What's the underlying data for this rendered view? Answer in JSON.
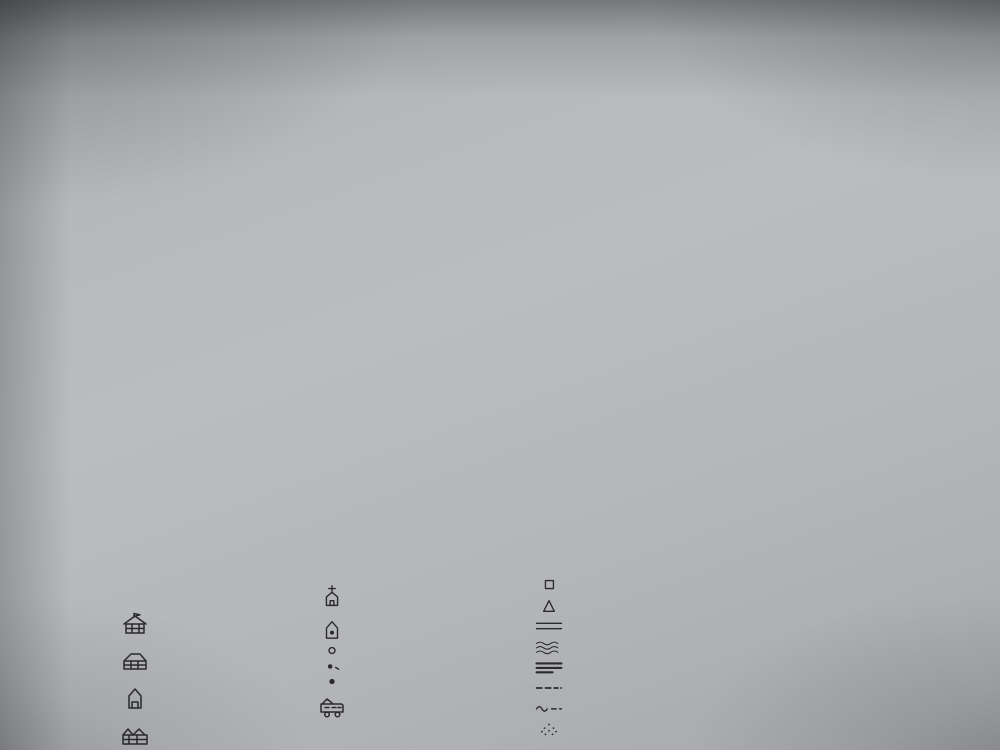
{
  "map": {
    "labels": [
      {
        "id": "ds-langir",
        "text": "DS. LANGIR"
      },
      {
        "id": "rt-07",
        "text": "RT. 07"
      },
      {
        "id": "dsn-hb-longir",
        "text": "Dsn. Hb. Longir"
      },
      {
        "id": "rt-09",
        "text": "RT. 09"
      },
      {
        "id": "jalan-maumere-larantuka",
        "text": "Maumere  -  Larantuka"
      },
      {
        "id": "laut-flores",
        "text": "Laut Flores"
      },
      {
        "id": "rt-10",
        "text": "RT. 10"
      },
      {
        "id": "rt-11",
        "text": "RT 11"
      },
      {
        "id": "rt-12",
        "text": "RT 12"
      },
      {
        "id": "rt-13",
        "text": "RT 13"
      },
      {
        "id": "dsn-wair-habi",
        "text": "Dsn. Wair Habi"
      },
      {
        "id": "rt-06",
        "text": "RT. 06"
      },
      {
        "id": "rt-05",
        "text": "RT 05"
      },
      {
        "id": "rt-03",
        "text": "RT. 03"
      },
      {
        "id": "rt-02",
        "text": "RT. 02"
      },
      {
        "id": "rt-01",
        "text": "RT 01"
      },
      {
        "id": "dsn-habi-gahar",
        "text": "Dsn Habi Gahar"
      },
      {
        "id": "rt-04",
        "text": "RT. 04"
      },
      {
        "id": "ds-watuliwung",
        "text": "DS. WATULIWUNG"
      },
      {
        "id": "compass-north",
        "text": "U"
      }
    ],
    "ink_color": "#2a2a2f",
    "paper_color": "#b7b9bc"
  },
  "legend": {
    "title": "Legenda:",
    "eq": "=",
    "col1": [
      {
        "icon": "school-icon",
        "label": "Sekolah (SD,TK,SMP)"
      },
      {
        "icon": "biara-icon",
        "label": "Biara"
      },
      {
        "icon": "posyandu-icon",
        "label": "Posyandu"
      },
      {
        "icon": "kantor-desa-icon",
        "label": "Kantor Desa"
      }
    ],
    "col2": [
      {
        "icon": "gereja-icon",
        "label": "Gereja / Kapela"
      },
      {
        "icon": "pustu-icon",
        "label": "Pustu / Polindes."
      },
      {
        "icon": "rumah-miskin-icon",
        "label": "Rumah Tg. Miskin"
      },
      {
        "icon": "rumah-kaya-icon",
        "label": "Rmh Tngga Kaya"
      },
      {
        "icon": "rumah-sedang-icon",
        "label": "Rmh Tngga Sedang"
      },
      {
        "icon": "terminal-bis-icon",
        "label": "Terminal Bis."
      }
    ],
    "col3": [
      {
        "icon": "embung-icon",
        "label": "Embung"
      },
      {
        "icon": "titik-air-icon",
        "label": "Titik Air"
      },
      {
        "icon": "jalan-raya-icon",
        "label": "Jalan Raya"
      },
      {
        "icon": "kali-icon",
        "label": "Kali"
      },
      {
        "icon": "jalan-dusun-icon",
        "label": "Jalan Dusun / Desa"
      },
      {
        "icon": "batas-desa-icon",
        "label": "Batas Desa"
      },
      {
        "icon": "batas-rt-icon",
        "label": "Batas RT"
      },
      {
        "icon": "klp-spkp-icon",
        "label": "Klp. SPKP."
      }
    ]
  }
}
